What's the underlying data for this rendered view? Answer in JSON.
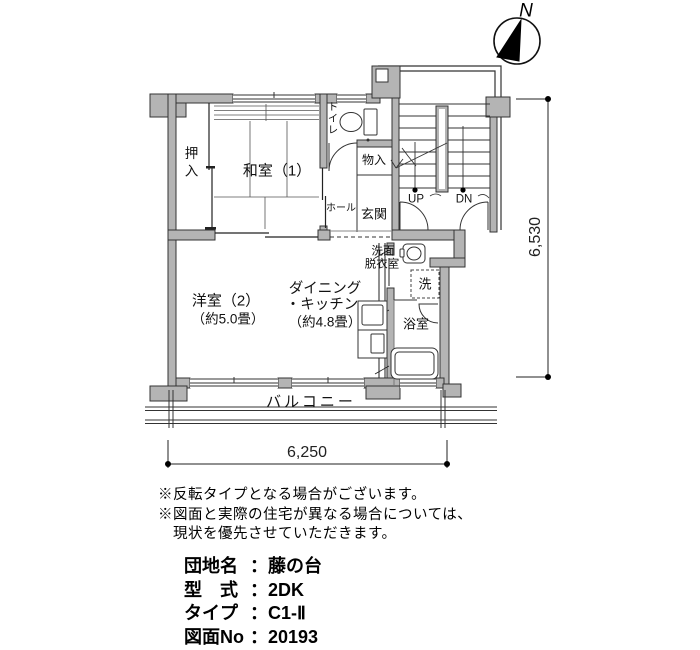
{
  "compass": {
    "north_label": "N"
  },
  "plan": {
    "rooms": {
      "oshiire": "押入",
      "washitsu": "和室（1）",
      "toilet": "トイレ",
      "monoire": "物入",
      "hall": "ホール",
      "genkan": "玄関",
      "stairs_up": "UP",
      "stairs_down": "DN",
      "senmen_line1": "洗面",
      "senmen_line2": "脱衣室",
      "washer": "洗",
      "bath": "浴室",
      "yoshitsu_line1": "洋室（2）",
      "yoshitsu_line2": "（約5.0畳）",
      "dk_line1": "ダイニング",
      "dk_line2": "・キッチン",
      "dk_line3": "（約4.8畳）",
      "balcony": "バルコニー"
    },
    "dimensions": {
      "vertical": "6,530",
      "horizontal": "6,250"
    }
  },
  "notes": {
    "line1": "※反転タイプとなる場合がございます。",
    "line2": "※図面と実際の住宅が異なる場合については、",
    "line3": "　現状を優先させていただきます。"
  },
  "info": {
    "estate": {
      "label": "団地名",
      "separator": "：",
      "value": "藤の台"
    },
    "layout": {
      "label": "型　式",
      "separator": "：",
      "value": "2DK"
    },
    "type": {
      "label": "タイプ",
      "separator": "：",
      "value": "C1-Ⅱ"
    },
    "drawing": {
      "label": "図面No",
      "separator": "：",
      "value": "20193"
    }
  }
}
